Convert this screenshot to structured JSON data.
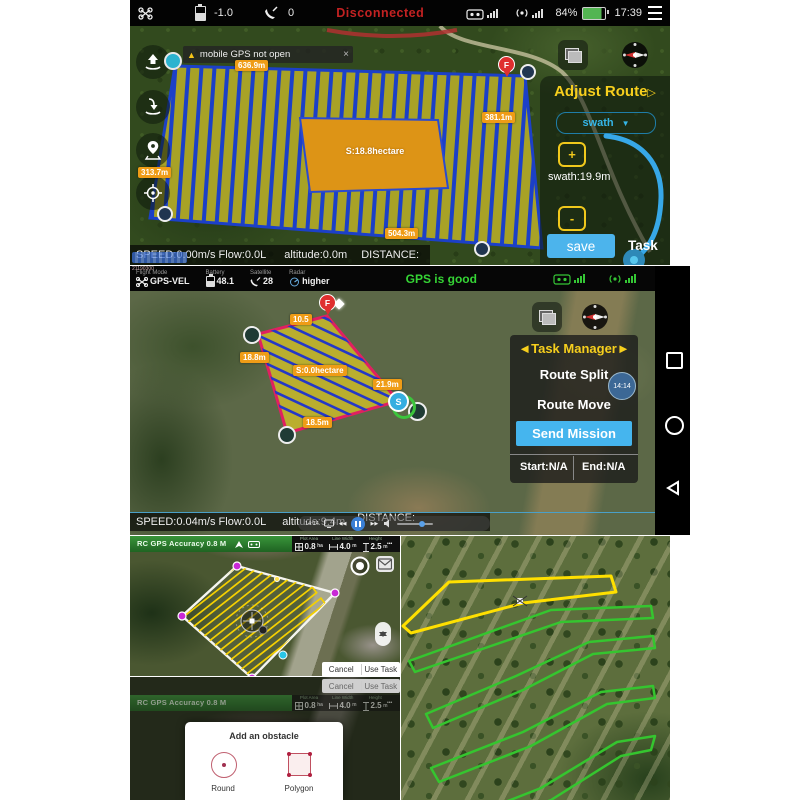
{
  "icons": {
    "caret": "▼",
    "warn": "▲",
    "close": "×",
    "more": "•••",
    "panel_arrow": "▷",
    "left_arrow": "◄",
    "right_arrow": "►",
    "rew": "◀◀",
    "ffw": "▶▶"
  },
  "p1": {
    "topbar": {
      "battery": "-1.0",
      "satellites": "0",
      "status": "Disconnected",
      "battery_pct": "84%",
      "time": "17:39"
    },
    "warning": {
      "text": "mobile GPS not open"
    },
    "map": {
      "top_len": "636.9m",
      "right_len": "381.1m",
      "left_len": "313.7m",
      "bottom_len": "504.3m",
      "area": "S:18.8hectare",
      "finish": "F"
    },
    "panel": {
      "title": "Adjust Route",
      "dropdown": "swath",
      "plus": "+",
      "minus": "-",
      "swath": "swath:19.9m",
      "save": "save",
      "task": "Task"
    },
    "bottombar": {
      "speed": "SPEED:0.00m/s Flow:0.0L",
      "altitude": "altitude:0.0m",
      "distance": "DISTANCE:"
    }
  },
  "p2": {
    "topbar": {
      "overlay": "21190300",
      "flight_mode_label": "Flight Mode",
      "flight_mode": "GPS-VEL",
      "battery_label": "Battery",
      "battery": "48.1",
      "satellite_label": "Satellite",
      "satellite": "28",
      "radar_label": "Radar",
      "radar": "higher",
      "gps_status": "GPS is good"
    },
    "map": {
      "top_len": "10.5",
      "left_len": "18.8m",
      "area": "S:0.0hectare",
      "right_len": "21.9m",
      "bottom_len": "18.5m",
      "start": "S",
      "finish": "F"
    },
    "panel": {
      "title": "Task Manager",
      "route_split": "Route Split",
      "badge": "14:14",
      "route_move": "Route Move",
      "send": "Send Mission",
      "start": "Start:N/A",
      "end": "End:N/A"
    },
    "bottombar": {
      "speed": "SPEED:0.04m/s Flow:0.0L",
      "altitude": "altitude:9.4m",
      "distance": "DISTANCE:",
      "video_time": "14:14"
    }
  },
  "p3": {
    "topbar": {
      "accuracy": "RC GPS Accuracy 0.8 M",
      "plot_label": "Plot Area",
      "plot": "0.8",
      "plot_unit": "ha",
      "width_label": "Line Width",
      "width": "4.0",
      "width_unit": "m",
      "height_label": "Height",
      "height": "2.5",
      "height_unit": "m"
    },
    "buttons": {
      "cancel": "Cancel",
      "use": "Use Task"
    }
  },
  "p4": {
    "buttons": {
      "cancel": "Cancel",
      "use": "Use Task"
    },
    "dialog": {
      "title": "Add an obstacle",
      "round": "Round",
      "polygon": "Polygon"
    }
  }
}
